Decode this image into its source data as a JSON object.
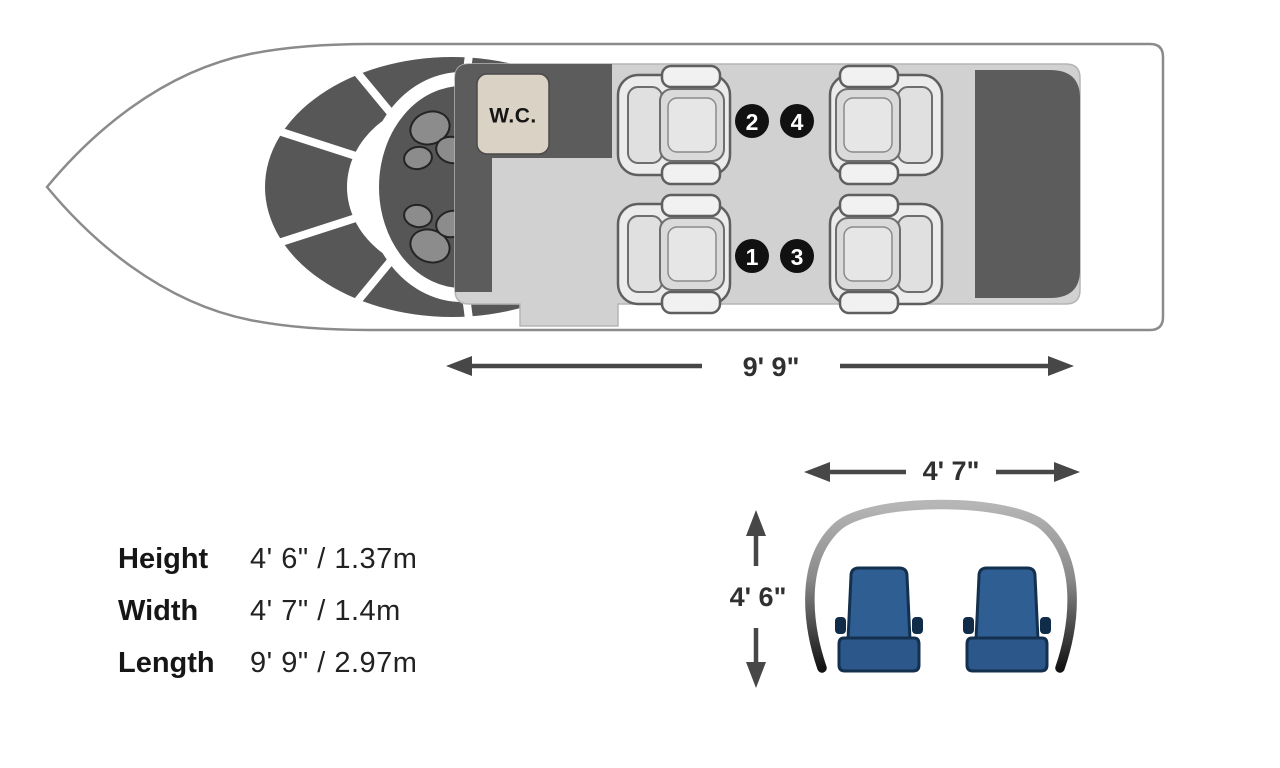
{
  "floorplan": {
    "wc_label": "W.C.",
    "seat_badges": [
      {
        "number": "2"
      },
      {
        "number": "4"
      },
      {
        "number": "1"
      },
      {
        "number": "3"
      }
    ],
    "length_label": "9' 9\""
  },
  "cross_section": {
    "width_label": "4' 7\"",
    "height_label": "4' 6\""
  },
  "specs": {
    "rows": [
      {
        "label": "Height",
        "value": "4' 6\" / 1.37m"
      },
      {
        "label": "Width",
        "value": "4' 7\" / 1.4m"
      },
      {
        "label": "Length",
        "value": "9' 9\" / 2.97m"
      }
    ]
  },
  "colors": {
    "structure_dark_gray": "#5c5c5c",
    "cabin_floor_gray": "#d1d1d1",
    "wc_beige": "#dbd2c6",
    "seat_fabric_blue": "#2e5e92",
    "outline_gray": "#8b8b8b",
    "badge_black": "#111111"
  }
}
